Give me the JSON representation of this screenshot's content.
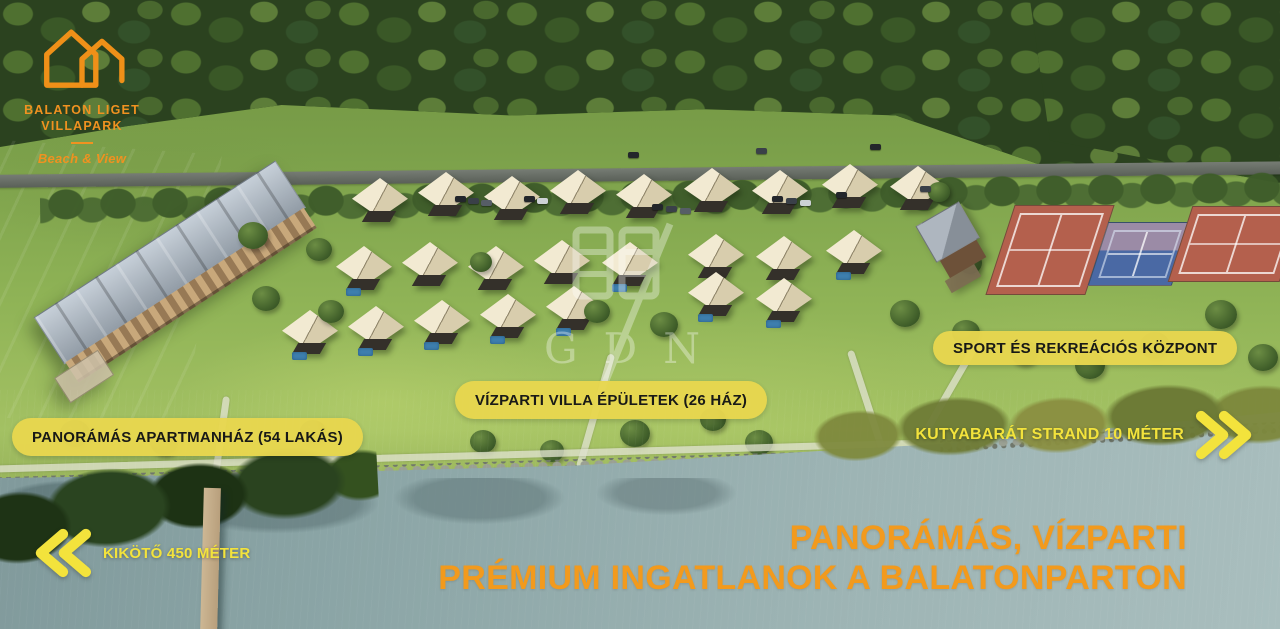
{
  "branding": {
    "name_line1": "BALATON LIGET",
    "name_line2": "VILLAPARK",
    "tagline": "Beach & View"
  },
  "labels": {
    "apartment_pill": "PANORÁMÁS APARTMANHÁZ (54 LAKÁS)",
    "villas_pill": "VÍZPARTI VILLA ÉPÜLETEK (26 HÁZ)",
    "sport_pill": "SPORT ÉS REKREÁCIÓS KÖZPONT",
    "beach_direction": "KUTYABARÁT STRAND 10 MÉTER",
    "harbor_direction": "KIKÖTŐ 450 MÉTER"
  },
  "headline": {
    "line1": "PANORÁMÁS, VÍZPARTI",
    "line2": "PRÉMIUM INGATLANOK A BALATONPARTON"
  },
  "watermark": {
    "text": "GDN"
  },
  "colors": {
    "pill_bg": "#E8D74F",
    "pill_text": "#141414",
    "accent_yellow": "#F3E33C",
    "accent_orange": "#F29A1D",
    "logo_orange": "#F09220"
  }
}
